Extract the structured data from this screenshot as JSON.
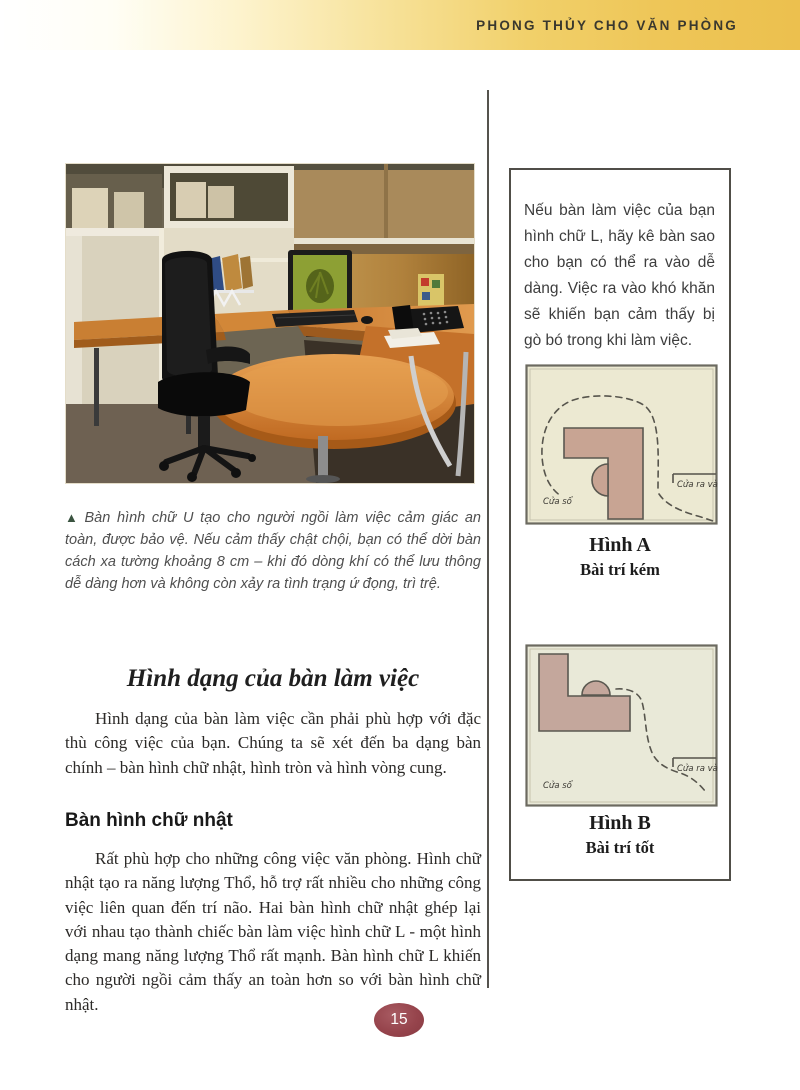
{
  "header": {
    "title": "PHONG THỦY CHO VĂN PHÒNG"
  },
  "photo": {
    "alt": "office-cubicle-with-u-shaped-desk",
    "caption_marker": "▲",
    "caption": "Bàn hình chữ U tạo cho người ngồi làm việc cảm giác an toàn, được bảo vệ. Nếu cảm thấy chật chội, bạn có thể dời bàn cách xa tường khoảng 8 cm – khi đó dòng khí có thể lưu thông dễ dàng hơn và không còn xảy ra tình trạng ứ đọng, trì trệ."
  },
  "main": {
    "heading": "Hình dạng của bàn làm việc",
    "para1": "Hình dạng của bàn làm việc cần phải phù hợp với đặc thù công việc của bạn. Chúng ta sẽ xét đến ba dạng bàn chính – bàn hình chữ nhật, hình tròn và hình vòng cung.",
    "subheading": "Bàn hình chữ nhật",
    "para2": "Rất phù hợp cho những công việc văn phòng. Hình chữ nhật tạo ra năng lượng Thổ, hỗ trợ rất nhiều cho những công việc liên quan đến trí não. Hai bàn hình chữ nhật ghép lại với nhau tạo thành chiếc bàn làm việc hình chữ L - một hình dạng mang năng lượng Thổ rất mạnh. Bàn hình chữ L khiến cho người ngồi cảm thấy an toàn hơn so với bàn hình chữ nhật."
  },
  "sidebar": {
    "note": "Nếu bàn làm việc của bạn hình chữ L, hãy kê bàn sao cho bạn có thể ra vào dễ dàng. Việc ra vào khó khăn sẽ khiến bạn cảm thấy bị gò bó trong khi làm việc.",
    "diagram_a": {
      "title": "Hình A",
      "subtitle": "Bài trí kém",
      "window_label": "Cửa sổ",
      "door_label": "Cửa ra vào"
    },
    "diagram_b": {
      "title": "Hình B",
      "subtitle": "Bài trí tốt",
      "window_label": "Cửa sổ",
      "door_label": "Cửa ra vào"
    }
  },
  "footer": {
    "page_number": "15"
  },
  "colors": {
    "header_gold": "#eec454",
    "page_oval_maroon": "#96444c",
    "caption_marker_green": "#3a5340",
    "diagram_desk_tan": "#c8a493",
    "diagram_room_a": "#ece9d2",
    "diagram_room_b": "#e9e9d8",
    "photo_desk_wood": "#cd8036"
  }
}
